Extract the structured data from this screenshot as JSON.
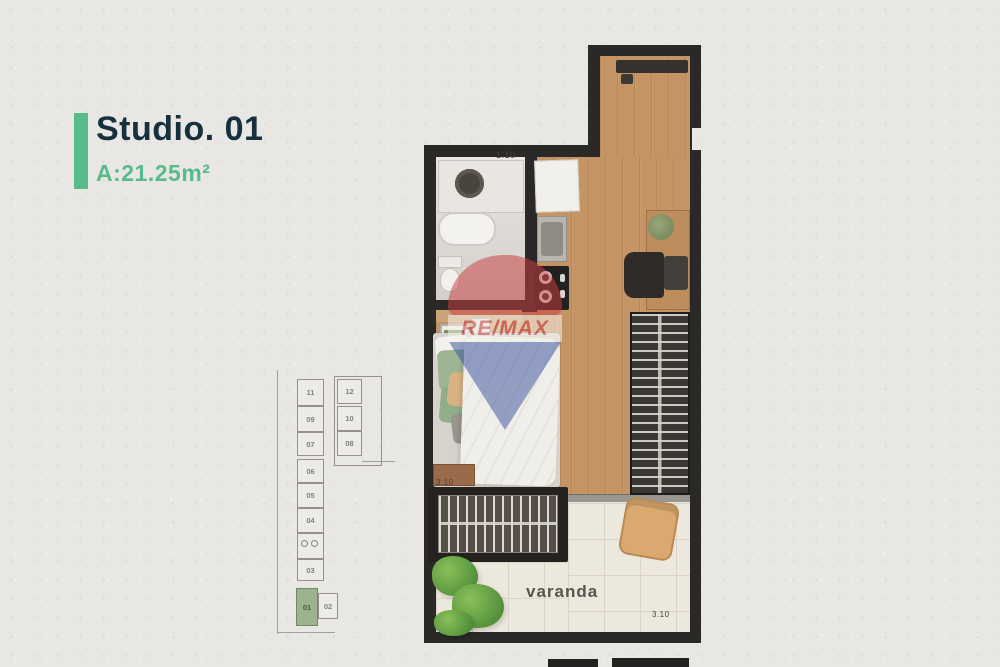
{
  "header": {
    "title": "Studio. 01",
    "area": "A:21.25m²",
    "accent_color": "#58bb8b",
    "title_color": "#16303c"
  },
  "watermark": {
    "brand": "RE/MAX",
    "red": "#c93f41",
    "blue": "#3b549f"
  },
  "floorplan": {
    "labels": {
      "bathroom_width": "1.10",
      "bed_width": "3.10",
      "balcony": "varanda",
      "balcony_width": "3.10"
    },
    "colors": {
      "wall": "#2a2927",
      "wood_floor": "#c59465",
      "balcony_tile": "#ece8dd",
      "bathroom_floor": "#dcd8d2"
    }
  },
  "keyplan": {
    "highlighted_unit": "01",
    "highlight_color": "#9cb38d",
    "cells": [
      {
        "label": "11"
      },
      {
        "label": "12"
      },
      {
        "label": "09"
      },
      {
        "label": "10"
      },
      {
        "label": "07"
      },
      {
        "label": "08"
      },
      {
        "label": "06"
      },
      {
        "label": "05"
      },
      {
        "label": "04"
      },
      {
        "label": "03"
      },
      {
        "label": "01"
      },
      {
        "label": "02"
      }
    ]
  }
}
